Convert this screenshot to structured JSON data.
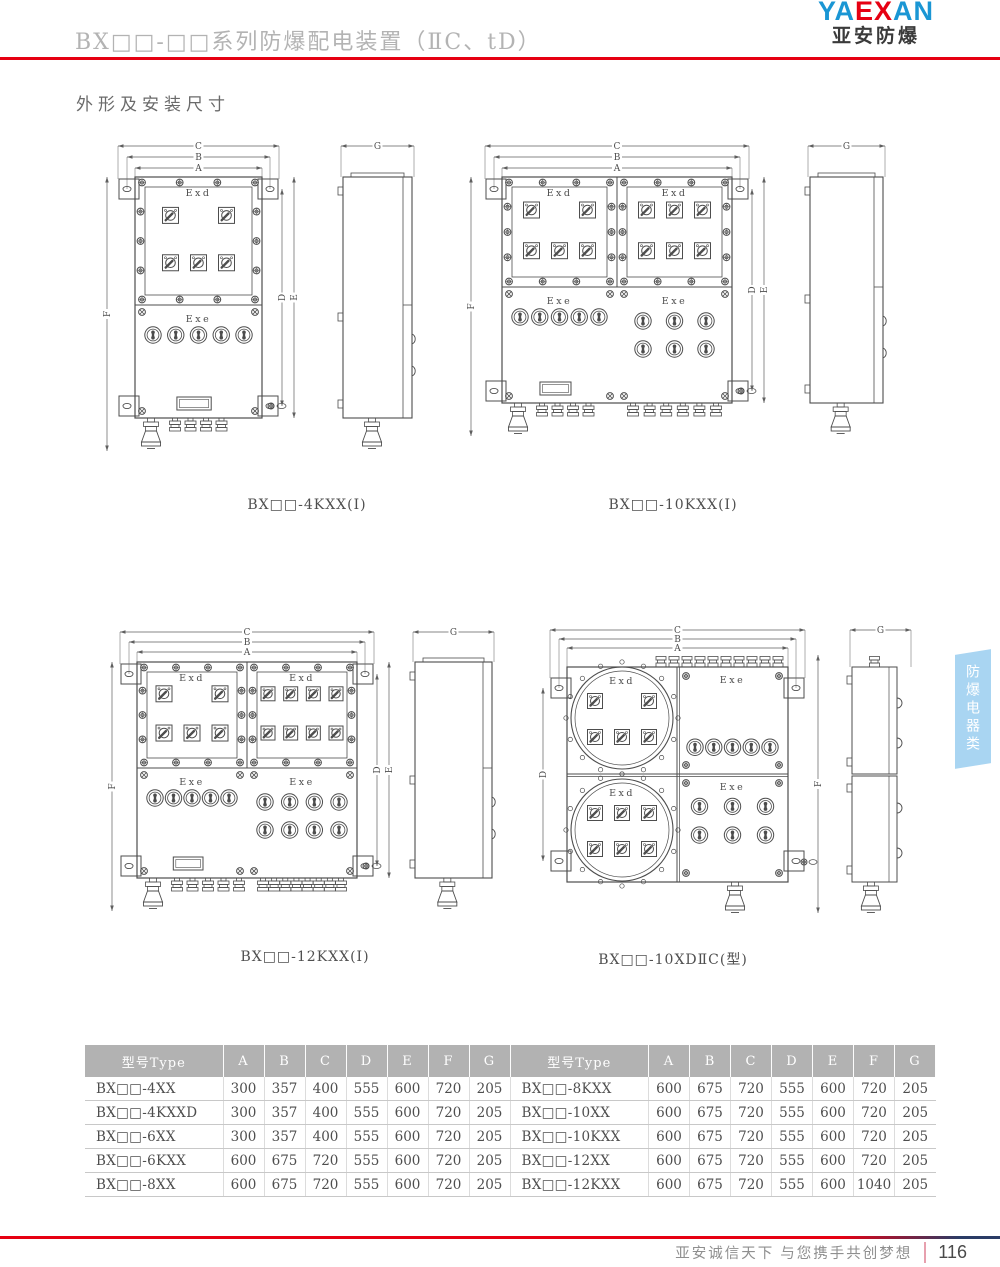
{
  "header": {
    "title": "BX□□-□□系列防爆配电装置（ⅡC、tD）",
    "logo": {
      "part1": "YA",
      "part2": "EX",
      "part3": "AN",
      "subtitle": "亚安防爆"
    }
  },
  "section_title": "外形及安装尺寸",
  "side_tab": {
    "label": "防爆电器类"
  },
  "drawings": [
    {
      "caption": "BX□□-4KXX(Ⅰ)",
      "door_label": "Exd",
      "lower_label": "Exe",
      "dims_top": [
        "C",
        "B",
        "A"
      ],
      "dim_left": "F",
      "dims_right": [
        "D",
        "E"
      ],
      "dim_side": "G",
      "panels": [
        {
          "switch_rows": [
            2,
            3
          ]
        }
      ],
      "lower_panels": [
        {
          "button_rows": [
            5
          ],
          "nameplate": true
        }
      ],
      "gland_groups": [
        {
          "big": true,
          "small": 4
        }
      ]
    },
    {
      "caption": "BX□□-10KXX(Ⅰ)",
      "door_label": "Exd",
      "lower_label": "Exe",
      "dims_top": [
        "C",
        "B",
        "A"
      ],
      "dim_left": "F",
      "dims_right": [
        "D",
        "E"
      ],
      "dim_side": "G",
      "panels": [
        {
          "switch_rows": [
            2,
            3
          ]
        },
        {
          "switch_rows": [
            3,
            3
          ]
        }
      ],
      "lower_panels": [
        {
          "button_rows": [
            5
          ],
          "nameplate": true
        },
        {
          "button_rows": [
            3,
            3
          ]
        }
      ],
      "gland_groups": [
        {
          "big": true,
          "small": 4
        },
        {
          "small": 6
        }
      ]
    },
    {
      "caption": "BX□□-12KXX(Ⅰ)",
      "door_label": "Exd",
      "lower_label": "Exe",
      "dims_top": [
        "C",
        "B",
        "A"
      ],
      "dim_left": "F",
      "dims_right": [
        "D",
        "E"
      ],
      "dim_side": "G",
      "panels": [
        {
          "switch_rows": [
            2,
            3
          ]
        },
        {
          "switch_rows": [
            4,
            4
          ]
        }
      ],
      "lower_panels": [
        {
          "button_rows": [
            5
          ],
          "nameplate": true
        },
        {
          "button_rows": [
            4,
            4
          ]
        }
      ],
      "gland_groups": [
        {
          "big": true,
          "small": 5
        },
        {
          "small": 8
        }
      ]
    },
    {
      "caption": "BX□□-10XDⅡC(型)",
      "round": true,
      "door_label": "Exd",
      "lower_label": "Exe",
      "dims_top": [
        "C",
        "B",
        "A"
      ],
      "dim_left": "D",
      "dim_right": "F",
      "dim_side": "G",
      "circle_panels": [
        {
          "switch_rows": [
            2,
            3
          ]
        },
        {
          "switch_rows": [
            3,
            3
          ]
        }
      ],
      "button_panels": [
        {
          "button_rows": [
            5
          ]
        },
        {
          "button_rows": [
            3,
            3
          ]
        }
      ],
      "top_gland_count": 10
    }
  ],
  "table": {
    "columns": [
      "型号Type",
      "A",
      "B",
      "C",
      "D",
      "E",
      "F",
      "G"
    ],
    "left_rows": [
      [
        "BX□□-4XX",
        "300",
        "357",
        "400",
        "555",
        "600",
        "720",
        "205"
      ],
      [
        "BX□□-4KXXD",
        "300",
        "357",
        "400",
        "555",
        "600",
        "720",
        "205"
      ],
      [
        "BX□□-6XX",
        "300",
        "357",
        "400",
        "555",
        "600",
        "720",
        "205"
      ],
      [
        "BX□□-6KXX",
        "600",
        "675",
        "720",
        "555",
        "600",
        "720",
        "205"
      ],
      [
        "BX□□-8XX",
        "600",
        "675",
        "720",
        "555",
        "600",
        "720",
        "205"
      ]
    ],
    "right_rows": [
      [
        "BX□□-8KXX",
        "600",
        "675",
        "720",
        "555",
        "600",
        "720",
        "205"
      ],
      [
        "BX□□-10XX",
        "600",
        "675",
        "720",
        "555",
        "600",
        "720",
        "205"
      ],
      [
        "BX□□-10KXX",
        "600",
        "675",
        "720",
        "555",
        "600",
        "720",
        "205"
      ],
      [
        "BX□□-12XX",
        "600",
        "675",
        "720",
        "555",
        "600",
        "720",
        "205"
      ],
      [
        "BX□□-12KXX",
        "600",
        "675",
        "720",
        "555",
        "600",
        "1040",
        "205"
      ]
    ]
  },
  "footer": {
    "slogan": "亚安诚信天下 与您携手共创梦想",
    "page": "116"
  },
  "colors": {
    "accent_red": "#e60012",
    "logo_blue": "#1a96d4",
    "footer_navy": "#2a3c66",
    "tab_blue": "#a9d5f2",
    "table_header_gray": "#b2b2b2",
    "drawing_line": "#4d4d4d"
  }
}
